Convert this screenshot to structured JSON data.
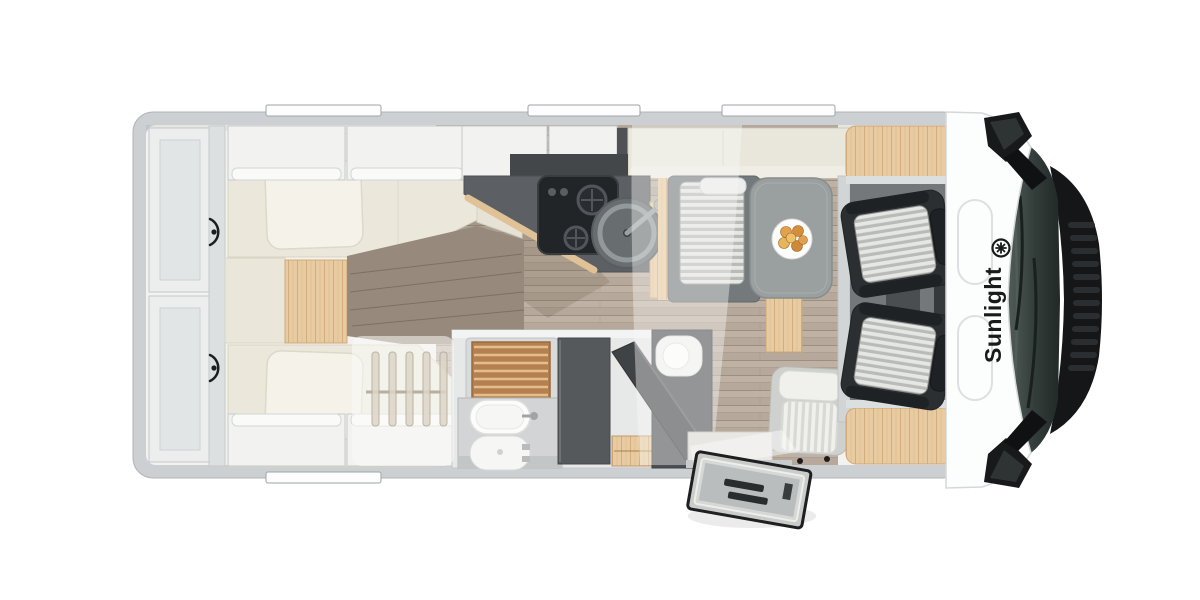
{
  "brand": {
    "label": "Sunlight",
    "logo_icon": "sunlight-asterisk-logo"
  },
  "scene": {
    "subject": "Motorhome floor plan, top-down view",
    "areas": [
      "rear-storage-shelves",
      "twin-single-beds",
      "under-bed-wardrobe",
      "kitchen",
      "bathroom",
      "dinette",
      "travel-seat",
      "entry-door",
      "cab-seats",
      "driver-cab"
    ]
  },
  "colors": {
    "background": "#ffffff",
    "body_wall": "#ccd0d2",
    "interior_floor": "#f3f2ef",
    "wood_floor": "#b6a89a",
    "wood_accent": "#e8cba1",
    "mattress": "#ebe8db",
    "kitchen_counter": "#5c6064",
    "stove": "#222527",
    "seat_dark": "#2c2f31",
    "cushion_stripe": "#e6e7e5",
    "windshield_glass": "#333d3a",
    "hood": "#141618",
    "cab_roof": "#fcfdfd",
    "brand_text": "#1a1a1a"
  }
}
